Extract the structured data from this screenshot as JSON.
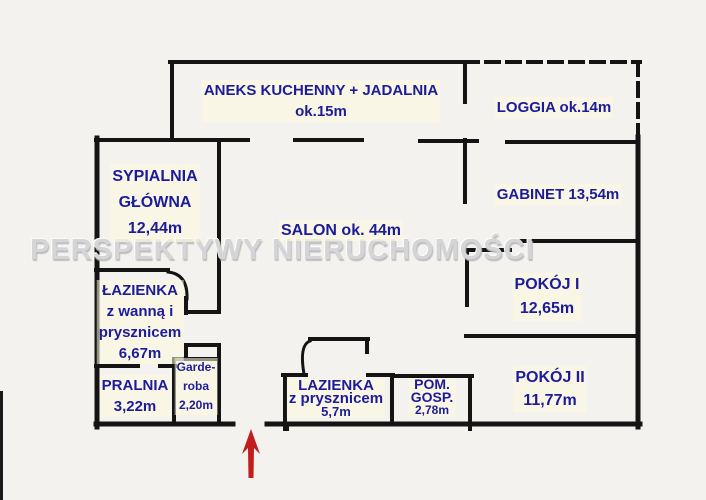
{
  "watermark": "PERSPEKTYWY NIERUCHOMOŚCI",
  "colors": {
    "label_text": "#1c1c9a",
    "walls": "#141414",
    "entrance_arrow": "#c21d1d",
    "watermark": "#d5d5d7"
  },
  "rooms": [
    {
      "id": "aneks-kuchenny",
      "lines": [
        "ANEKS KUCHENNY + JADALNIA",
        "ok.15m"
      ]
    },
    {
      "id": "loggia",
      "lines": [
        "LOGGIA ok.14m"
      ]
    },
    {
      "id": "sypialnia-glowna",
      "lines": [
        "SYPIALNIA",
        "GŁÓWNA",
        "12,44m"
      ]
    },
    {
      "id": "salon",
      "lines": [
        "SALON ok. 44m"
      ]
    },
    {
      "id": "gabinet",
      "lines": [
        "GABINET 13,54m"
      ]
    },
    {
      "id": "pokoj-1",
      "lines": [
        "POKÓJ I",
        "12,65m"
      ]
    },
    {
      "id": "pokoj-2",
      "lines": [
        "POKÓJ II",
        "11,77m"
      ]
    },
    {
      "id": "lazienka-z-wanna",
      "lines": [
        "ŁAZIENKA",
        "z wanną i",
        "prysznicem",
        "6,67m"
      ]
    },
    {
      "id": "pralnia",
      "lines": [
        "PRALNIA",
        "3,22m"
      ]
    },
    {
      "id": "garderoba",
      "lines": [
        "Garde-",
        "roba",
        "2,20m"
      ]
    },
    {
      "id": "lazienka-z-prysznicem",
      "lines": [
        "LAZIENKA",
        "z prysznicem",
        "5,7m"
      ]
    },
    {
      "id": "pom-gosp",
      "lines": [
        "POM.",
        "GOSP.",
        "2,78m"
      ]
    }
  ]
}
